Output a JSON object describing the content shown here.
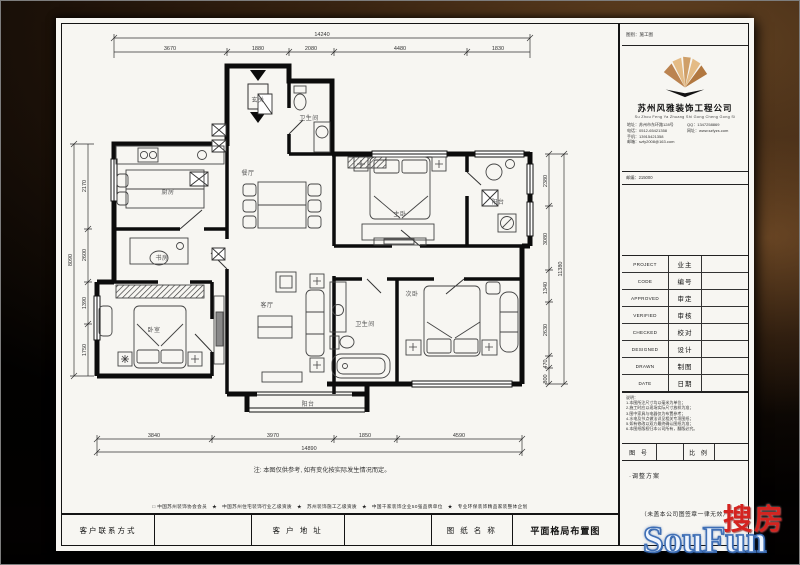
{
  "sheet": {
    "plan": {
      "rooms": [
        {
          "label": "厨房"
        },
        {
          "label": "书房"
        },
        {
          "label": "卧室"
        },
        {
          "label": "玄关"
        },
        {
          "label": "卫生间"
        },
        {
          "label": "餐厅"
        },
        {
          "label": "客厅"
        },
        {
          "label": "主卧"
        },
        {
          "label": "阳台"
        },
        {
          "label": "卫生间"
        },
        {
          "label": "次卧"
        },
        {
          "label": "阳台"
        }
      ],
      "dims": {
        "top": [
          "3670",
          "1880",
          "2080",
          "4480",
          "1830"
        ],
        "top_total": "14240",
        "bottom": [
          "3840",
          "3970",
          "1850",
          "4590"
        ],
        "bottom_total": "14890",
        "left": [
          "2170",
          "2600",
          "1390",
          "1750"
        ],
        "left_total": "8090",
        "right": [
          "2380",
          "3080",
          "1340",
          "2630",
          "470",
          "800"
        ],
        "right_total": "11380"
      },
      "note": "注: 本图仅供参考, 如有变化按实际发生情况而定。"
    },
    "credentials_line": "□ 中国苏州装饰协会会员　★　中国苏州住宅装饰行业乙级资质　★　苏州装饰施工乙级资质　★　中国千家装饰企业50强品牌单位　★　专业环保装饰精品家装整体企划",
    "bottom_fields": {
      "contact_label": "客户联系方式",
      "address_label": "客 户 地 址",
      "drawing_label": "图 纸 名 称",
      "drawing_name": "平面格局布置图"
    },
    "titleblock": {
      "top_note": "图别：施工图",
      "company_cn": "苏州风雅装饰工程公司",
      "company_en": "Su Zhou Feng Ya Zhuang Shi Gong Cheng Gong Si",
      "contact_left": [
        "地址：苏州市东环路128号",
        "电话：0512-65421358",
        "手机：13915421358",
        "邮箱：szfy2008@163.com"
      ],
      "contact_right": [
        "QQ：1347258869",
        "网址：www.szfyzs.com"
      ],
      "zip_note": "邮编：215000",
      "rows": [
        {
          "en": "PROJECT",
          "cn": "业主"
        },
        {
          "en": "CODE",
          "cn": "编号"
        },
        {
          "en": "APPROVED",
          "cn": "审定"
        },
        {
          "en": "VERIFIED",
          "cn": "审核"
        },
        {
          "en": "CHECKED",
          "cn": "校对"
        },
        {
          "en": "DESIGNED",
          "cn": "设计"
        },
        {
          "en": "DRAWN",
          "cn": "制图"
        },
        {
          "en": "DATE",
          "cn": "日期"
        }
      ],
      "notes_title": "说明：",
      "notes": [
        "1.本图所注尺寸均以毫米为单位；",
        "2.施工时应以现场实际尺寸放样为准；",
        "3.图中家具与电器仅为布置参考；",
        "4.水电及节点做法详见相关专项图纸；",
        "5.如有修改以双方最终确认图纸为准；",
        "6.本图纸版权归本公司所有，翻版必究。"
      ],
      "fig_no_label": "图 号",
      "scale_label": "比 例",
      "adjust_note": "·调整方案",
      "validity_note": "（未盖本公司图签章一律无效）"
    }
  },
  "watermark": {
    "cn": "搜房",
    "en": "SouFun"
  }
}
